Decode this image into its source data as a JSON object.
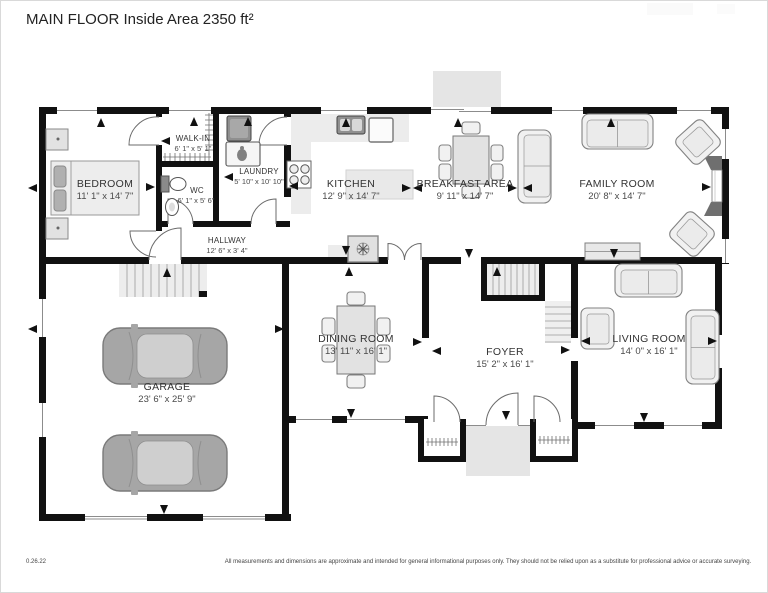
{
  "title": "MAIN FLOOR Inside Area 2350 ft²",
  "footer": {
    "date": "0.26.22",
    "disclaimer": "All measurements and dimensions are approximate and intended for general informational purposes only. They should not be relied upon as a substitute for professional advice or accurate surveying."
  },
  "colors": {
    "wall": "#111111",
    "furniture_fill": "#f1f1f1",
    "furniture_stroke": "#828282",
    "car_fill": "#a6a6a6",
    "deck_fill": "#e5e5e5",
    "stair_fill": "#ededed",
    "label": "#333333"
  },
  "rooms": [
    {
      "name": "BEDROOM",
      "dims": "11' 1\" x 14' 7\""
    },
    {
      "name": "WALK-IN",
      "dims": "6' 1\" x 5' 1\""
    },
    {
      "name": "WC",
      "dims": "6' 1\" x 5' 6\""
    },
    {
      "name": "LAUNDRY",
      "dims": "5' 10\" x 10' 10\""
    },
    {
      "name": "HALLWAY",
      "dims": "12' 6\" x 3' 4\""
    },
    {
      "name": "KITCHEN",
      "dims": "12' 9\" x 14' 7\""
    },
    {
      "name": "BREAKFAST AREA",
      "dims": "9' 11\" x 14' 7\""
    },
    {
      "name": "FAMILY ROOM",
      "dims": "20' 8\" x 14' 7\""
    },
    {
      "name": "DINING ROOM",
      "dims": "13' 11\" x 16' 1\""
    },
    {
      "name": "FOYER",
      "dims": "15' 2\" x 16' 1\""
    },
    {
      "name": "LIVING ROOM",
      "dims": "14' 0\" x 16' 1\""
    },
    {
      "name": "GARAGE",
      "dims": "23' 6\" x 25' 9\""
    }
  ]
}
